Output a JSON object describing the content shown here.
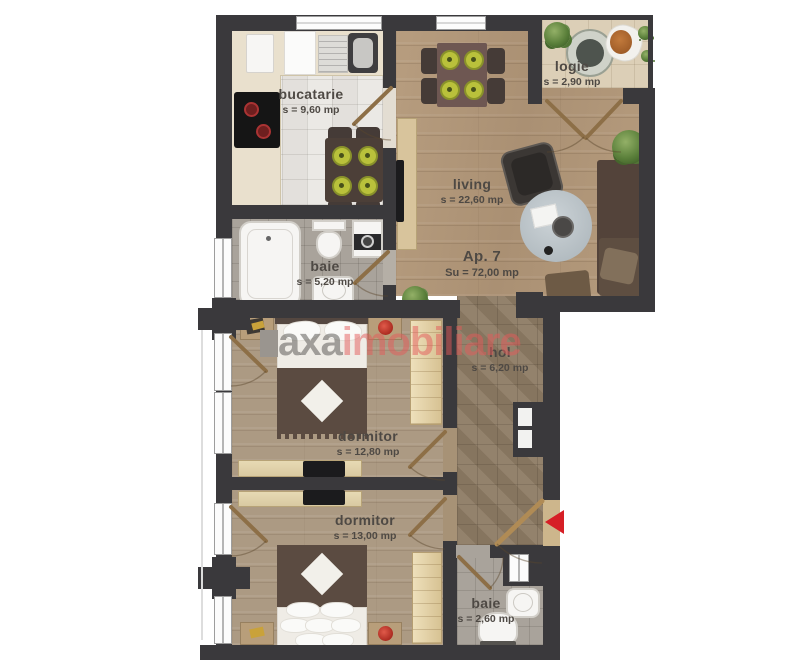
{
  "apartment": {
    "label": "Ap. 7",
    "area": "Su = 72,00 mp"
  },
  "rooms": {
    "bucatarie": {
      "name": "bucatarie",
      "area": "s = 9,60 mp"
    },
    "logie": {
      "name": "logie",
      "area": "s = 2,90 mp"
    },
    "living": {
      "name": "living",
      "area": "s = 22,60 mp"
    },
    "baie_main": {
      "name": "baie",
      "area": "s = 5,20 mp"
    },
    "hol": {
      "name": "hol",
      "area": "s = 6,20 mp"
    },
    "dormitor_1": {
      "name": "dormitor",
      "area": "s = 12,80 mp"
    },
    "dormitor_2": {
      "name": "dormitor",
      "area": "s = 13,00 mp"
    },
    "baie_small": {
      "name": "baie",
      "area": "s = 2,60 mp"
    }
  },
  "watermark": {
    "part1": "axa",
    "part2": "imobiliare"
  },
  "entrance": {
    "marker": "left-arrow"
  },
  "colors": {
    "wall": "#3a393c",
    "entrance_arrow": "#d61f26",
    "watermark_gray": "#5f5d5a",
    "watermark_red": "#e45a5a",
    "plate_green": "#b9c13b",
    "wood_living": "#b49a7c",
    "tile_hol": "#8d7b64"
  }
}
